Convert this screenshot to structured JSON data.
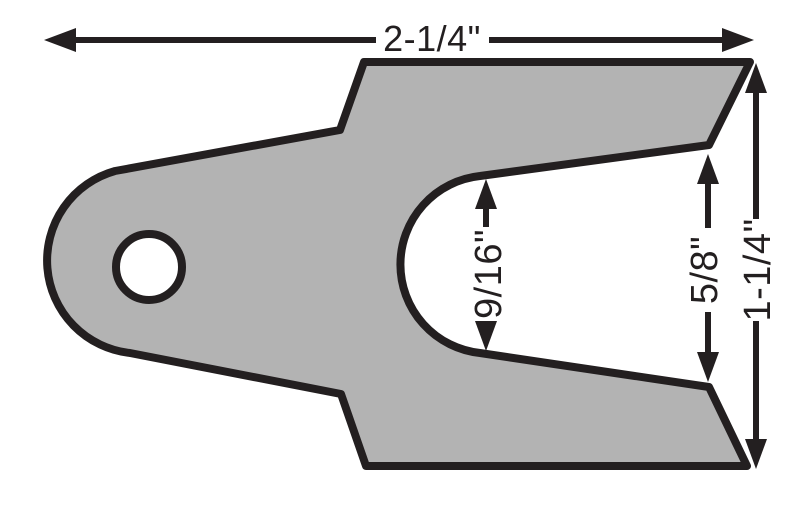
{
  "dimensions": {
    "overall_width": "2-1/4\"",
    "slot_width": "9/16\"",
    "opening_width": "5/8\"",
    "end_width": "1-1/4\""
  },
  "colors": {
    "shim_fill": "#b3b3b3",
    "line": "#231f20",
    "background": "#ffffff"
  }
}
